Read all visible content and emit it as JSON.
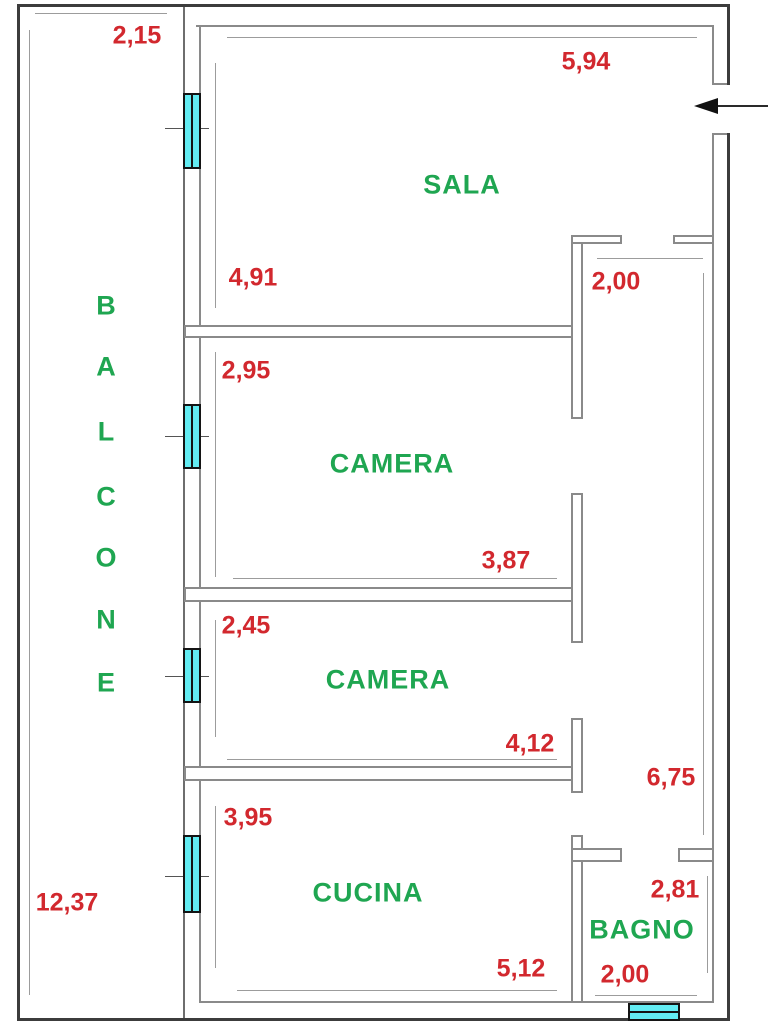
{
  "plan": {
    "type": "apartment-floor-plan",
    "room_labels": [
      {
        "id": "sala",
        "text": "SALA"
      },
      {
        "id": "camera1",
        "text": "CAMERA"
      },
      {
        "id": "camera2",
        "text": "CAMERA"
      },
      {
        "id": "cucina",
        "text": "CUCINA"
      },
      {
        "id": "bagno",
        "text": "BAGNO"
      }
    ],
    "balcony_name": "BALCONE",
    "balcony_letters": [
      "B",
      "A",
      "L",
      "C",
      "O",
      "N",
      "E"
    ],
    "dimensions": [
      {
        "id": "balcone-width",
        "text": "2,15"
      },
      {
        "id": "sala-width",
        "text": "5,94"
      },
      {
        "id": "sala-depth",
        "text": "4,91"
      },
      {
        "id": "corridor-width",
        "text": "2,00"
      },
      {
        "id": "camera1-depth",
        "text": "2,95"
      },
      {
        "id": "camera1-width",
        "text": "3,87"
      },
      {
        "id": "camera2-depth",
        "text": "2,45"
      },
      {
        "id": "camera2-width",
        "text": "4,12"
      },
      {
        "id": "corridor-length",
        "text": "6,75"
      },
      {
        "id": "cucina-depth",
        "text": "3,95"
      },
      {
        "id": "cucina-width",
        "text": "5,12"
      },
      {
        "id": "bagno-depth",
        "text": "2,81"
      },
      {
        "id": "bagno-width",
        "text": "2,00"
      },
      {
        "id": "balcone-length",
        "text": "12,37"
      }
    ],
    "colors": {
      "dimension_red": "#d2282e",
      "room_green": "#1fa651",
      "window_cyan": "#63ecf2",
      "wall_gray": "#8a8a8a",
      "outline_dark": "#3c3c3c"
    }
  }
}
